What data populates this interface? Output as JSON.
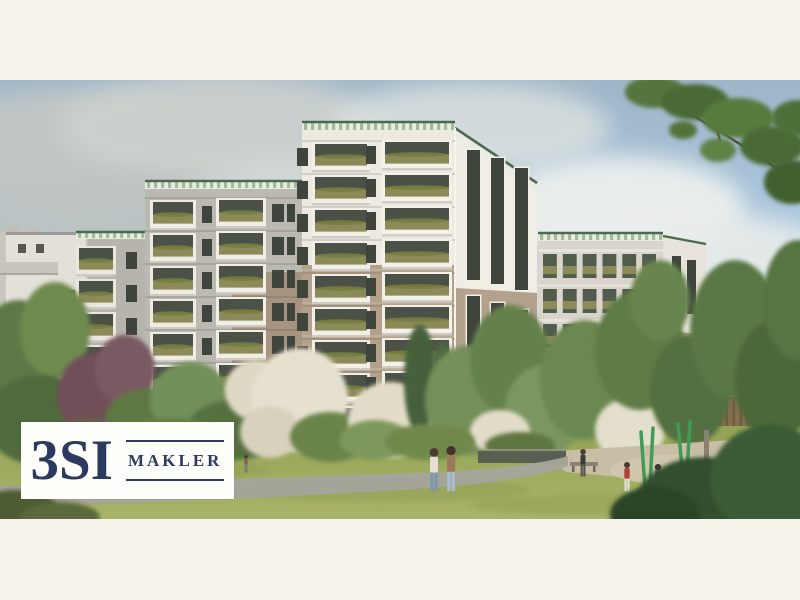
{
  "watermark": {
    "brand": "3SI",
    "label": "MAKLER",
    "text_color": "#2B3A5E",
    "background": "#FEFEFB"
  },
  "frame": {
    "letterbox_color": "#F5F2EA",
    "photo_top": 80,
    "photo_height": 439
  },
  "palette": {
    "sky_top": "#9FB6C8",
    "sky_mid": "#A9C6DF",
    "sky_low": "#C6D8E6",
    "sky_horizon": "#DCE6EC",
    "facade_white": "#ECE9E1",
    "facade_lit": "#F0EDE5",
    "facade_shadow": "#B6B4AC",
    "facade_shadow2": "#BBB9B1",
    "tan": "#B3A18C",
    "tan_shadow": "#A6947F",
    "balcony_frame": "#F1EEE6",
    "balcony_opening": "#4C5147",
    "railing": "#8D8A59",
    "planter_green": "#75803F",
    "parapet_base": "#E9ECE2",
    "parapet_green": "#A3BB9B",
    "roof_green": "#4C6852",
    "window_dark": "#3F443D",
    "slab_line": "#C8BCAB",
    "lawn": "#9FAC5F",
    "lawn_dark": "#87964E",
    "path": "#A5A49A",
    "fence": "#84704E",
    "fence_dark": "#6E5C40",
    "apron": "#C8BEA6",
    "sand": "#D2C8AD",
    "wall": "#596051",
    "bench": "#8B8274",
    "trunk": "#8A8173",
    "post_green": "#3F9B55",
    "branch_wood": "#4E4634",
    "left_building": "#E3E0D9",
    "right_building": "#D9D5CC"
  },
  "scene": {
    "clouds": [
      [
        70,
        150,
        150,
        60,
        "#C3C7C4",
        0.95
      ],
      [
        220,
        128,
        160,
        55,
        "#CDD1CD",
        0.9
      ],
      [
        120,
        235,
        175,
        62,
        "#BEC3C0",
        0.85
      ],
      [
        330,
        210,
        150,
        55,
        "#D8DBD6",
        0.8
      ],
      [
        40,
        320,
        120,
        45,
        "#C8CCC8",
        0.7
      ],
      [
        280,
        300,
        150,
        45,
        "#D4D7D2",
        0.6
      ],
      [
        470,
        128,
        140,
        45,
        "#DFE3DF",
        0.8
      ],
      [
        620,
        208,
        125,
        52,
        "#EEF1EE",
        0.95
      ],
      [
        705,
        258,
        130,
        46,
        "#E9EDEA",
        0.9
      ],
      [
        560,
        300,
        120,
        40,
        "#DEE4E0",
        0.6
      ]
    ],
    "balcony_columns": [
      {
        "x": 76,
        "w": 40,
        "yTop": 246,
        "fh": 33,
        "rows": 6,
        "frame": "#EAE7DF"
      },
      {
        "x": 150,
        "w": 46,
        "yTop": 200,
        "fh": 33,
        "rows": 7,
        "frame": "#EFECE4"
      },
      {
        "x": 216,
        "w": 50,
        "yTop": 198,
        "fh": 33,
        "rows": 7,
        "frame": "#F1EEE6"
      },
      {
        "x": 312,
        "w": 58,
        "yTop": 142,
        "fh": 33,
        "rows": 9,
        "frame": "#F2EFE7"
      },
      {
        "x": 382,
        "w": 70,
        "yTop": 140,
        "fh": 33,
        "rows": 9,
        "frame": "#F4F1E9"
      }
    ],
    "window_columns": [
      {
        "x": 126,
        "yTop": 252,
        "w": 11,
        "h": 17,
        "rows": 6,
        "dy": 33
      },
      {
        "x": 202,
        "yTop": 206,
        "w": 10,
        "h": 17,
        "rows": 7,
        "dy": 33
      },
      {
        "x": 272,
        "yTop": 204,
        "w": 12,
        "h": 18,
        "rows": 7,
        "dy": 33
      },
      {
        "x": 287,
        "yTop": 204,
        "w": 8,
        "h": 18,
        "rows": 7,
        "dy": 33
      },
      {
        "x": 297,
        "yTop": 148,
        "w": 11,
        "h": 18,
        "rows": 9,
        "dy": 33
      },
      {
        "x": 366,
        "yTop": 146,
        "w": 10,
        "h": 18,
        "rows": 9,
        "dy": 33
      }
    ],
    "tower_strips_upper": [
      [
        467,
        150,
        13,
        130
      ],
      [
        491,
        158,
        13,
        126
      ],
      [
        515,
        168,
        13,
        122
      ]
    ],
    "tower_strips_lower": [
      [
        467,
        296,
        13,
        98
      ],
      [
        491,
        303,
        13,
        95
      ],
      [
        515,
        310,
        13,
        92
      ]
    ],
    "left_windows": [
      [
        46,
        290,
        9,
        16
      ],
      [
        66,
        290,
        9,
        16
      ],
      [
        46,
        320,
        9,
        16
      ],
      [
        66,
        320,
        9,
        16
      ],
      [
        46,
        350,
        9,
        16
      ],
      [
        18,
        244,
        8,
        9
      ],
      [
        36,
        244,
        8,
        9
      ]
    ],
    "right_building": {
      "x": 538,
      "y": 240,
      "w": 125,
      "rows": 4,
      "cols": 6,
      "rowH": 35,
      "gridTop": 252,
      "sideX2": 706
    },
    "vegetation_back": [
      [
        18,
        360,
        42,
        60,
        "#5F7846"
      ],
      [
        55,
        330,
        35,
        48,
        "#6E8A50"
      ],
      [
        40,
        420,
        55,
        45,
        "#4F6A3C"
      ],
      [
        95,
        395,
        38,
        42,
        "#6F5058"
      ],
      [
        125,
        370,
        30,
        35,
        "#7A5A62"
      ],
      [
        150,
        420,
        45,
        32,
        "#5E7843"
      ],
      [
        190,
        400,
        40,
        38,
        "#72905A"
      ],
      [
        235,
        430,
        48,
        30,
        "#55713F"
      ],
      [
        255,
        390,
        30,
        30,
        "#DFD8C4"
      ],
      [
        300,
        400,
        48,
        52,
        "#E6E0CF"
      ],
      [
        270,
        432,
        30,
        26,
        "#D8D1BD"
      ],
      [
        330,
        437,
        40,
        25,
        "#6B8449"
      ],
      [
        390,
        420,
        42,
        38,
        "#E3DCC8"
      ],
      [
        375,
        440,
        35,
        20,
        "#7E975C"
      ],
      [
        420,
        380,
        16,
        55,
        "#45603A"
      ],
      [
        443,
        390,
        13,
        48,
        "#50693F"
      ],
      [
        470,
        400,
        45,
        55,
        "#74905A"
      ],
      [
        510,
        360,
        40,
        55,
        "#65814B"
      ],
      [
        545,
        410,
        40,
        45,
        "#7B965E"
      ],
      [
        500,
        432,
        30,
        22,
        "#E2DCC9"
      ],
      [
        585,
        380,
        45,
        60,
        "#6A8850"
      ],
      [
        630,
        430,
        35,
        32,
        "#E4DECC"
      ],
      [
        640,
        350,
        45,
        60,
        "#5E7C46"
      ],
      [
        690,
        390,
        40,
        55,
        "#52703F"
      ],
      [
        660,
        300,
        30,
        40,
        "#67854E"
      ],
      [
        735,
        330,
        45,
        70,
        "#5A7845"
      ],
      [
        775,
        380,
        40,
        60,
        "#4C6839"
      ],
      [
        798,
        300,
        35,
        60,
        "#567543"
      ],
      [
        170,
        440,
        50,
        22,
        "#697F44"
      ],
      [
        90,
        440,
        40,
        20,
        "#5C7240"
      ],
      [
        430,
        442,
        45,
        18,
        "#71884C"
      ],
      [
        520,
        446,
        35,
        14,
        "#60763F"
      ]
    ],
    "vegetation_front": [
      [
        705,
        505,
        70,
        48,
        "#31502E"
      ],
      [
        770,
        480,
        60,
        55,
        "#3A5C35"
      ],
      [
        655,
        515,
        45,
        28,
        "#2C4528"
      ],
      [
        15,
        512,
        45,
        22,
        "#4E5C33"
      ],
      [
        60,
        518,
        40,
        16,
        "#5A6A3A"
      ]
    ],
    "branch_clusters": [
      [
        655,
        92,
        30,
        16,
        "#54743C"
      ],
      [
        695,
        102,
        34,
        18,
        "#4A6A35"
      ],
      [
        738,
        118,
        36,
        20,
        "#567B3E"
      ],
      [
        772,
        146,
        32,
        20,
        "#4A6A35"
      ],
      [
        792,
        182,
        28,
        22,
        "#42612F"
      ],
      [
        718,
        150,
        18,
        12,
        "#5E8245"
      ],
      [
        683,
        130,
        14,
        9,
        "#527239"
      ],
      [
        798,
        118,
        26,
        18,
        "#4E7038"
      ]
    ],
    "branch_stems": [
      "M646,90 Q720,128 790,178",
      "M700,106 Q726,136 719,154"
    ],
    "people": [
      {
        "x": 434,
        "y": 448,
        "h": 44,
        "top": "#E6DFD1",
        "legs": "#7F96AC",
        "head": "#4A3A30"
      },
      {
        "x": 451,
        "y": 446,
        "h": 46,
        "top": "#9C7A58",
        "legs": "#AABDCE",
        "head": "#3F332B"
      },
      {
        "x": 583,
        "y": 449,
        "h": 28,
        "top": "#3C3C3E",
        "legs": "#54504A",
        "head": "#4A3A30"
      },
      {
        "x": 627,
        "y": 462,
        "h": 30,
        "top": "#B24238",
        "legs": "#E4E0D6",
        "head": "#4A3A30"
      },
      {
        "x": 658,
        "y": 464,
        "h": 32,
        "top": "#50708E",
        "legs": "#6A6E72",
        "head": "#3F332B"
      },
      {
        "x": 671,
        "y": 466,
        "h": 30,
        "top": "#C2A37E",
        "legs": "#8A8E90",
        "head": "#4A3A30"
      },
      {
        "x": 246,
        "y": 455,
        "h": 18,
        "top": "#8A5A4A",
        "legs": "#777B70",
        "head": "#4A3A30"
      }
    ],
    "posts": [
      [
        641,
        432,
        645,
        488
      ],
      [
        653,
        428,
        650,
        486
      ],
      [
        678,
        424,
        684,
        490
      ],
      [
        690,
        422,
        686,
        488
      ],
      [
        757,
        432,
        761,
        472
      ],
      [
        768,
        430,
        764,
        470
      ]
    ]
  }
}
